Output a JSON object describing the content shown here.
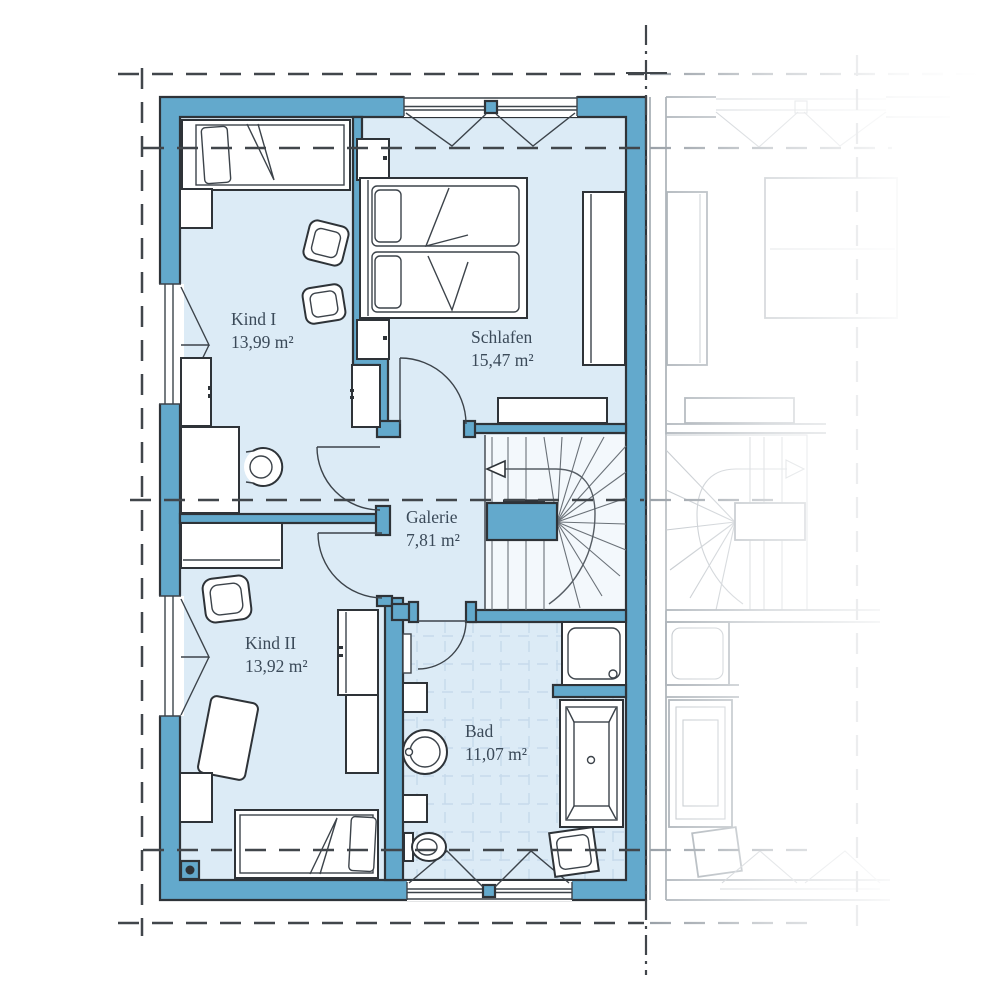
{
  "plan": {
    "type": "floorplan-upper-storey",
    "rooms": [
      {
        "id": "kind1",
        "label": "Kind I",
        "area": "13,99 m²"
      },
      {
        "id": "schlafen",
        "label": "Schlafen",
        "area": "15,47 m²"
      },
      {
        "id": "galerie",
        "label": "Galerie",
        "area": "7,81 m²"
      },
      {
        "id": "kind2",
        "label": "Kind II",
        "area": "13,92 m²"
      },
      {
        "id": "bad",
        "label": "Bad",
        "area": "11,07 m²"
      }
    ],
    "colors": {
      "wall": "#63a9cc",
      "floor": "#dcebf6",
      "stairfloor": "#f3f8fc",
      "tile": "#c6daeb",
      "outline": "#2e3338",
      "text": "#3b4a59",
      "dash": "#41464b",
      "faded": "#aab1b7"
    }
  }
}
